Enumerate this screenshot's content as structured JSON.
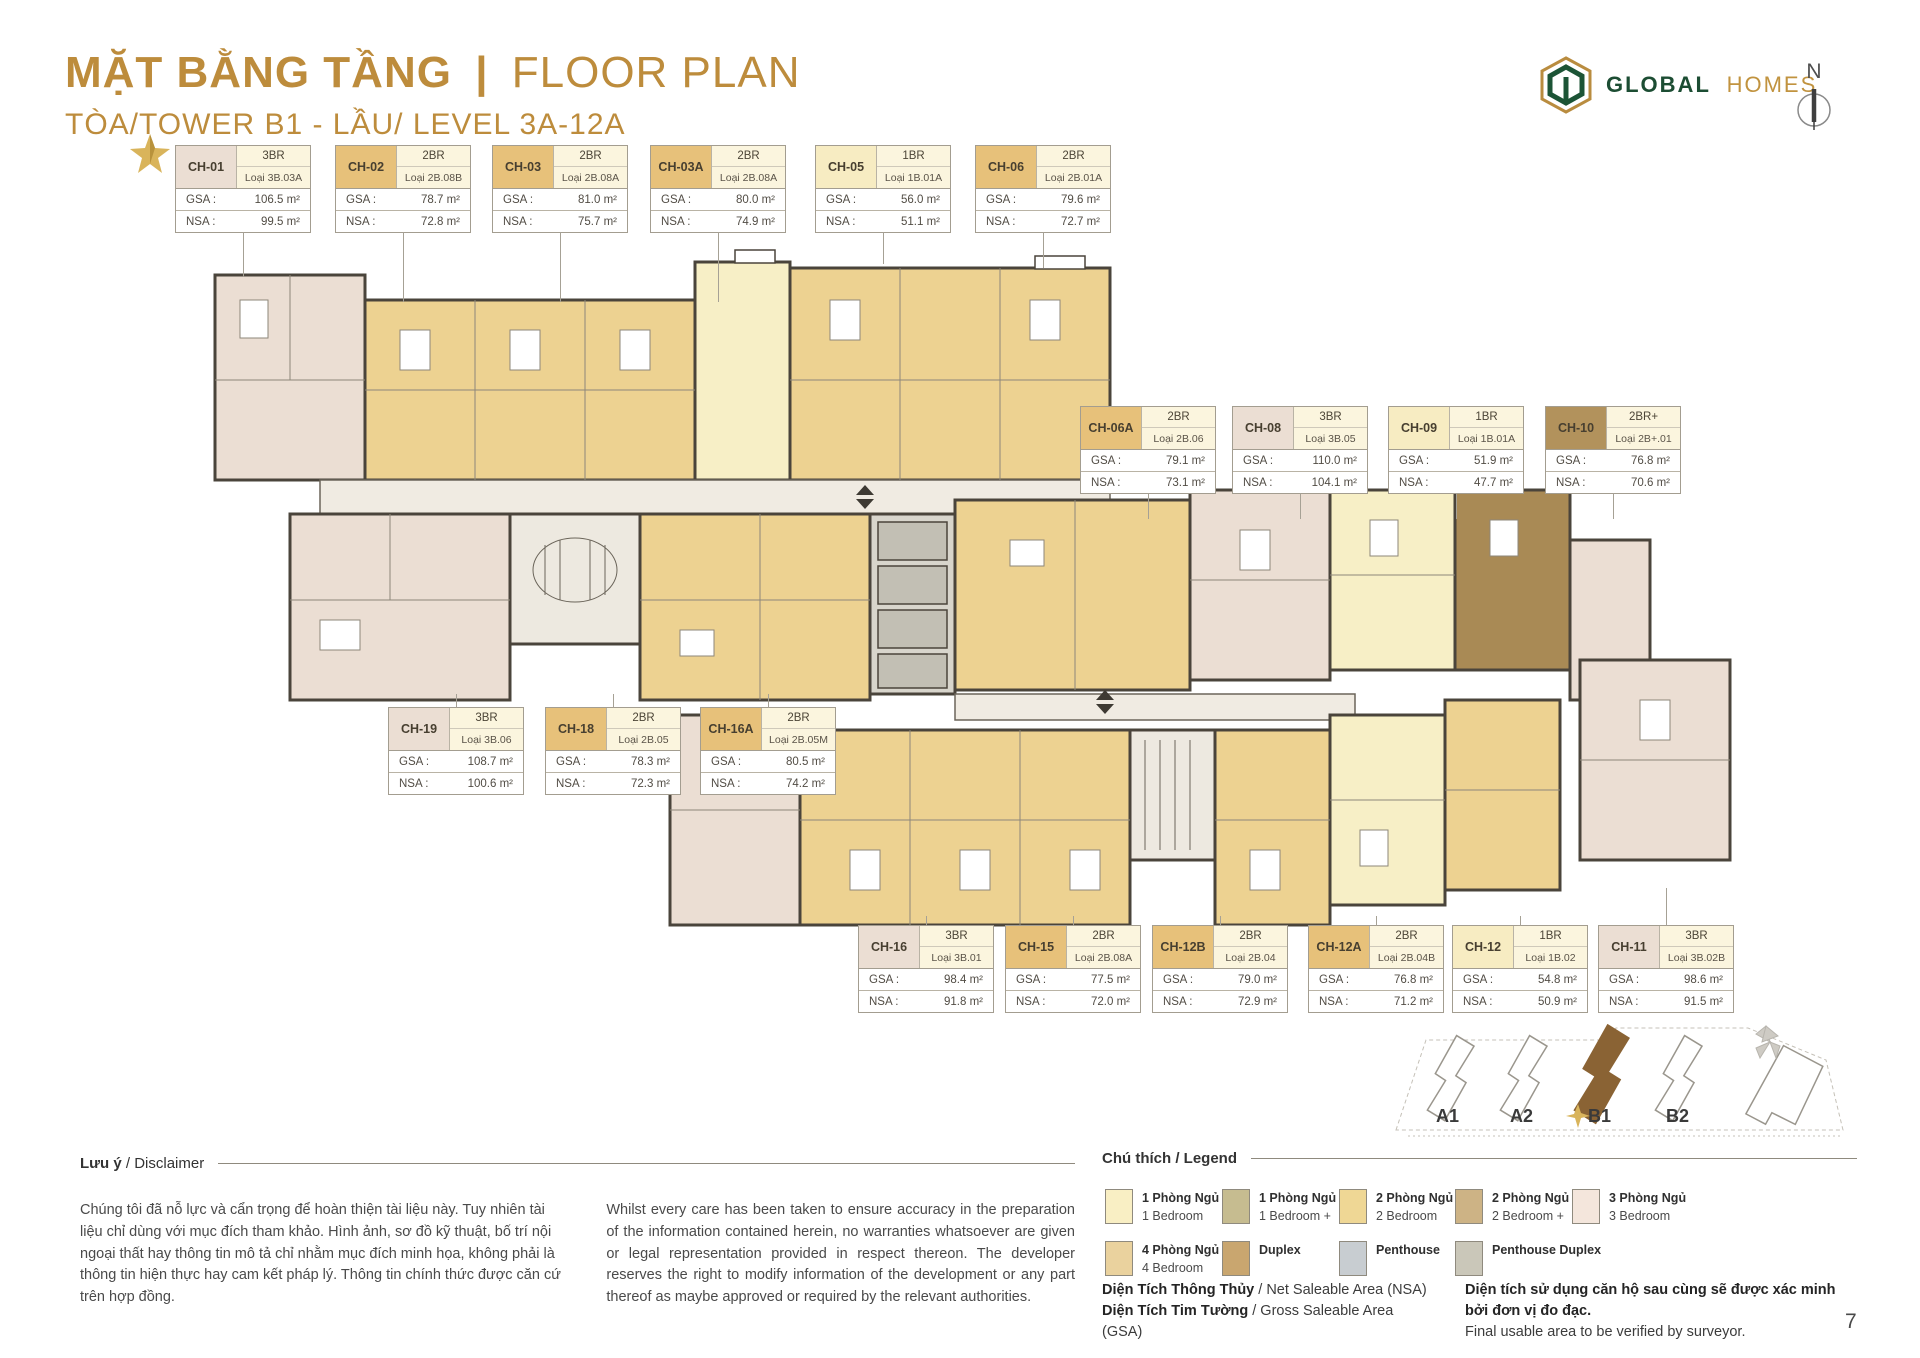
{
  "header": {
    "title_vi": "MẶT BẰNG TẦNG",
    "title_sep": "|",
    "title_en": "FLOOR PLAN",
    "subtitle": "TÒA/TOWER B1 - LẦU/ LEVEL 3A-12A",
    "brand_primary": "GLOBAL",
    "brand_secondary": "HOMES",
    "compass_label": "N",
    "accent_color": "#bd8c3c"
  },
  "cards": {
    "gsa_label": "GSA :",
    "nsa_label": "NSA :",
    "list": [
      {
        "code": "CH-01",
        "br": "3BR",
        "loai": "Loại 3B.03A",
        "gsa": "106.5 m²",
        "nsa": "99.5 m²",
        "type": "3BR",
        "x": 175,
        "y": 145,
        "dir": "down",
        "leader": 45,
        "starred": true
      },
      {
        "code": "CH-02",
        "br": "2BR",
        "loai": "Loại 2B.08B",
        "gsa": "78.7 m²",
        "nsa": "72.8 m²",
        "type": "2BR",
        "x": 335,
        "y": 145,
        "dir": "down",
        "leader": 70
      },
      {
        "code": "CH-03",
        "br": "2BR",
        "loai": "Loại 2B.08A",
        "gsa": "81.0 m²",
        "nsa": "75.7 m²",
        "type": "2BR",
        "x": 492,
        "y": 145,
        "dir": "down",
        "leader": 70
      },
      {
        "code": "CH-03A",
        "br": "2BR",
        "loai": "Loại 2B.08A",
        "gsa": "80.0 m²",
        "nsa": "74.9 m²",
        "type": "2BR",
        "x": 650,
        "y": 145,
        "dir": "down",
        "leader": 70
      },
      {
        "code": "CH-05",
        "br": "1BR",
        "loai": "Loại 1B.01A",
        "gsa": "56.0 m²",
        "nsa": "51.1 m²",
        "type": "1BR",
        "x": 815,
        "y": 145,
        "dir": "down",
        "leader": 32
      },
      {
        "code": "CH-06",
        "br": "2BR",
        "loai": "Loại 2B.01A",
        "gsa": "79.6 m²",
        "nsa": "72.7 m²",
        "type": "2BR",
        "x": 975,
        "y": 145,
        "dir": "down",
        "leader": 36
      },
      {
        "code": "CH-06A",
        "br": "2BR",
        "loai": "Loại 2B.06",
        "gsa": "79.1 m²",
        "nsa": "73.1 m²",
        "type": "2BR",
        "x": 1080,
        "y": 406,
        "dir": "down",
        "leader": 26
      },
      {
        "code": "CH-08",
        "br": "3BR",
        "loai": "Loại 3B.05",
        "gsa": "110.0 m²",
        "nsa": "104.1 m²",
        "type": "3BR",
        "x": 1232,
        "y": 406,
        "dir": "down",
        "leader": 26
      },
      {
        "code": "CH-09",
        "br": "1BR",
        "loai": "Loại 1B.01A",
        "gsa": "51.9 m²",
        "nsa": "47.7 m²",
        "type": "1BR",
        "x": 1388,
        "y": 406,
        "dir": "down",
        "leader": 26
      },
      {
        "code": "CH-10",
        "br": "2BR+",
        "loai": "Loại 2B+.01",
        "gsa": "76.8 m²",
        "nsa": "70.6 m²",
        "type": "2BR+",
        "x": 1545,
        "y": 406,
        "dir": "down",
        "leader": 26
      },
      {
        "code": "CH-19",
        "br": "3BR",
        "loai": "Loại 3B.06",
        "gsa": "108.7 m²",
        "nsa": "100.6 m²",
        "type": "3BR",
        "x": 388,
        "y": 707,
        "dir": "up",
        "leader": 14
      },
      {
        "code": "CH-18",
        "br": "2BR",
        "loai": "Loại 2B.05",
        "gsa": "78.3 m²",
        "nsa": "72.3 m²",
        "type": "2BR",
        "x": 545,
        "y": 707,
        "dir": "up",
        "leader": 14
      },
      {
        "code": "CH-16A",
        "br": "2BR",
        "loai": "Loại 2B.05M",
        "gsa": "80.5 m²",
        "nsa": "74.2 m²",
        "type": "2BR",
        "x": 700,
        "y": 707,
        "dir": "up",
        "leader": 14
      },
      {
        "code": "CH-16",
        "br": "3BR",
        "loai": "Loại 3B.01",
        "gsa": "98.4 m²",
        "nsa": "91.8 m²",
        "type": "3BR",
        "x": 858,
        "y": 925,
        "dir": "up",
        "leader": 10
      },
      {
        "code": "CH-15",
        "br": "2BR",
        "loai": "Loại 2B.08A",
        "gsa": "77.5 m²",
        "nsa": "72.0 m²",
        "type": "2BR",
        "x": 1005,
        "y": 925,
        "dir": "up",
        "leader": 10
      },
      {
        "code": "CH-12B",
        "br": "2BR",
        "loai": "Loại 2B.04",
        "gsa": "79.0 m²",
        "nsa": "72.9 m²",
        "type": "2BR",
        "x": 1152,
        "y": 925,
        "dir": "up",
        "leader": 10
      },
      {
        "code": "CH-12A",
        "br": "2BR",
        "loai": "Loại 2B.04B",
        "gsa": "76.8 m²",
        "nsa": "71.2 m²",
        "type": "2BR",
        "x": 1308,
        "y": 925,
        "dir": "up",
        "leader": 10
      },
      {
        "code": "CH-12",
        "br": "1BR",
        "loai": "Loại 1B.02",
        "gsa": "54.8 m²",
        "nsa": "50.9 m²",
        "type": "1BR",
        "x": 1452,
        "y": 925,
        "dir": "up",
        "leader": 10
      },
      {
        "code": "CH-11",
        "br": "3BR",
        "loai": "Loại 3B.02B",
        "gsa": "98.6 m²",
        "nsa": "91.5 m²",
        "type": "3BR",
        "x": 1598,
        "y": 925,
        "dir": "up",
        "leader": 38
      }
    ]
  },
  "plan": {
    "unit_colors": {
      "1BR": "#f7ecc2",
      "2BR": "#e7c17a",
      "2BR+": "#b2925c",
      "3BR": "#ebded3"
    },
    "wall_color": "#4a443b",
    "corridor_color": "#f0ebe2",
    "core_color": "#c9c6bd"
  },
  "minimap": {
    "towers": [
      "A1",
      "A2",
      "B1",
      "B2"
    ],
    "highlighted": "B1",
    "highlight_color": "#8a6334"
  },
  "disclaimer": {
    "heading_bold": "Lưu ý",
    "heading_rest": " / Disclaimer",
    "vi": "Chúng tôi đã nỗ lực và cẩn trọng để hoàn thiện tài liệu này. Tuy nhiên tài liệu chỉ dùng với mục đích tham khảo. Hình ảnh, sơ đồ kỹ thuật, bố trí nội ngoại thất hay thông tin mô tả chỉ nhằm mục đích minh họa, không phải là thông tin hiện thực hay cam kết pháp lý. Thông tin chính thức được căn cứ trên hợp đồng.",
    "en": "Whilst every care has been taken to ensure accuracy in the preparation of the information contained herein, no warranties whatsoever are given or legal representation provided in respect thereon. The developer reserves the right to modify information of the development or any part thereof as maybe approved or required by the relevant authorities."
  },
  "legend": {
    "heading": "Chú thích / Legend",
    "items": [
      {
        "vi": "1 Phòng Ngủ",
        "en": "1 Bedroom",
        "color": "#f9efc4",
        "x": 3,
        "y": 22
      },
      {
        "vi": "1 Phòng Ngủ +",
        "en": "1 Bedroom +",
        "color": "#c6bc90",
        "x": 120,
        "y": 22
      },
      {
        "vi": "2 Phòng Ngủ",
        "en": "2 Bedroom",
        "color": "#efd795",
        "x": 237,
        "y": 22
      },
      {
        "vi": "2 Phòng Ngủ +",
        "en": "2 Bedroom +",
        "color": "#cdb385",
        "x": 353,
        "y": 22
      },
      {
        "vi": "3 Phòng Ngủ",
        "en": "3 Bedroom",
        "color": "#f4e6dc",
        "x": 470,
        "y": 22
      },
      {
        "vi": "4 Phòng Ngủ",
        "en": "4 Bedroom",
        "color": "#ead29e",
        "hatch": true,
        "x": 3,
        "y": 74
      },
      {
        "vi": "Duplex",
        "en": "",
        "color": "#c9a66f",
        "x": 120,
        "y": 74
      },
      {
        "vi": "Penthouse",
        "en": "",
        "color": "#c8cdd1",
        "x": 237,
        "y": 74
      },
      {
        "vi": "Penthouse Duplex",
        "en": "",
        "color": "#cac7b9",
        "x": 353,
        "y": 74
      }
    ]
  },
  "area_notes": {
    "nsa_bold": "Diện Tích Thông Thủy",
    "nsa_rest": " / Net Saleable Area (NSA)",
    "gsa_bold": "Diện Tích Tim Tường",
    "gsa_rest": " / Gross Saleable Area (GSA)",
    "verify_vi": "Diện tích sử dụng căn hộ sau cùng sẽ được xác minh bởi đơn vị đo đạc.",
    "verify_en": "Final usable area to be verified by surveyor."
  },
  "footer": {
    "page_number": "7"
  }
}
